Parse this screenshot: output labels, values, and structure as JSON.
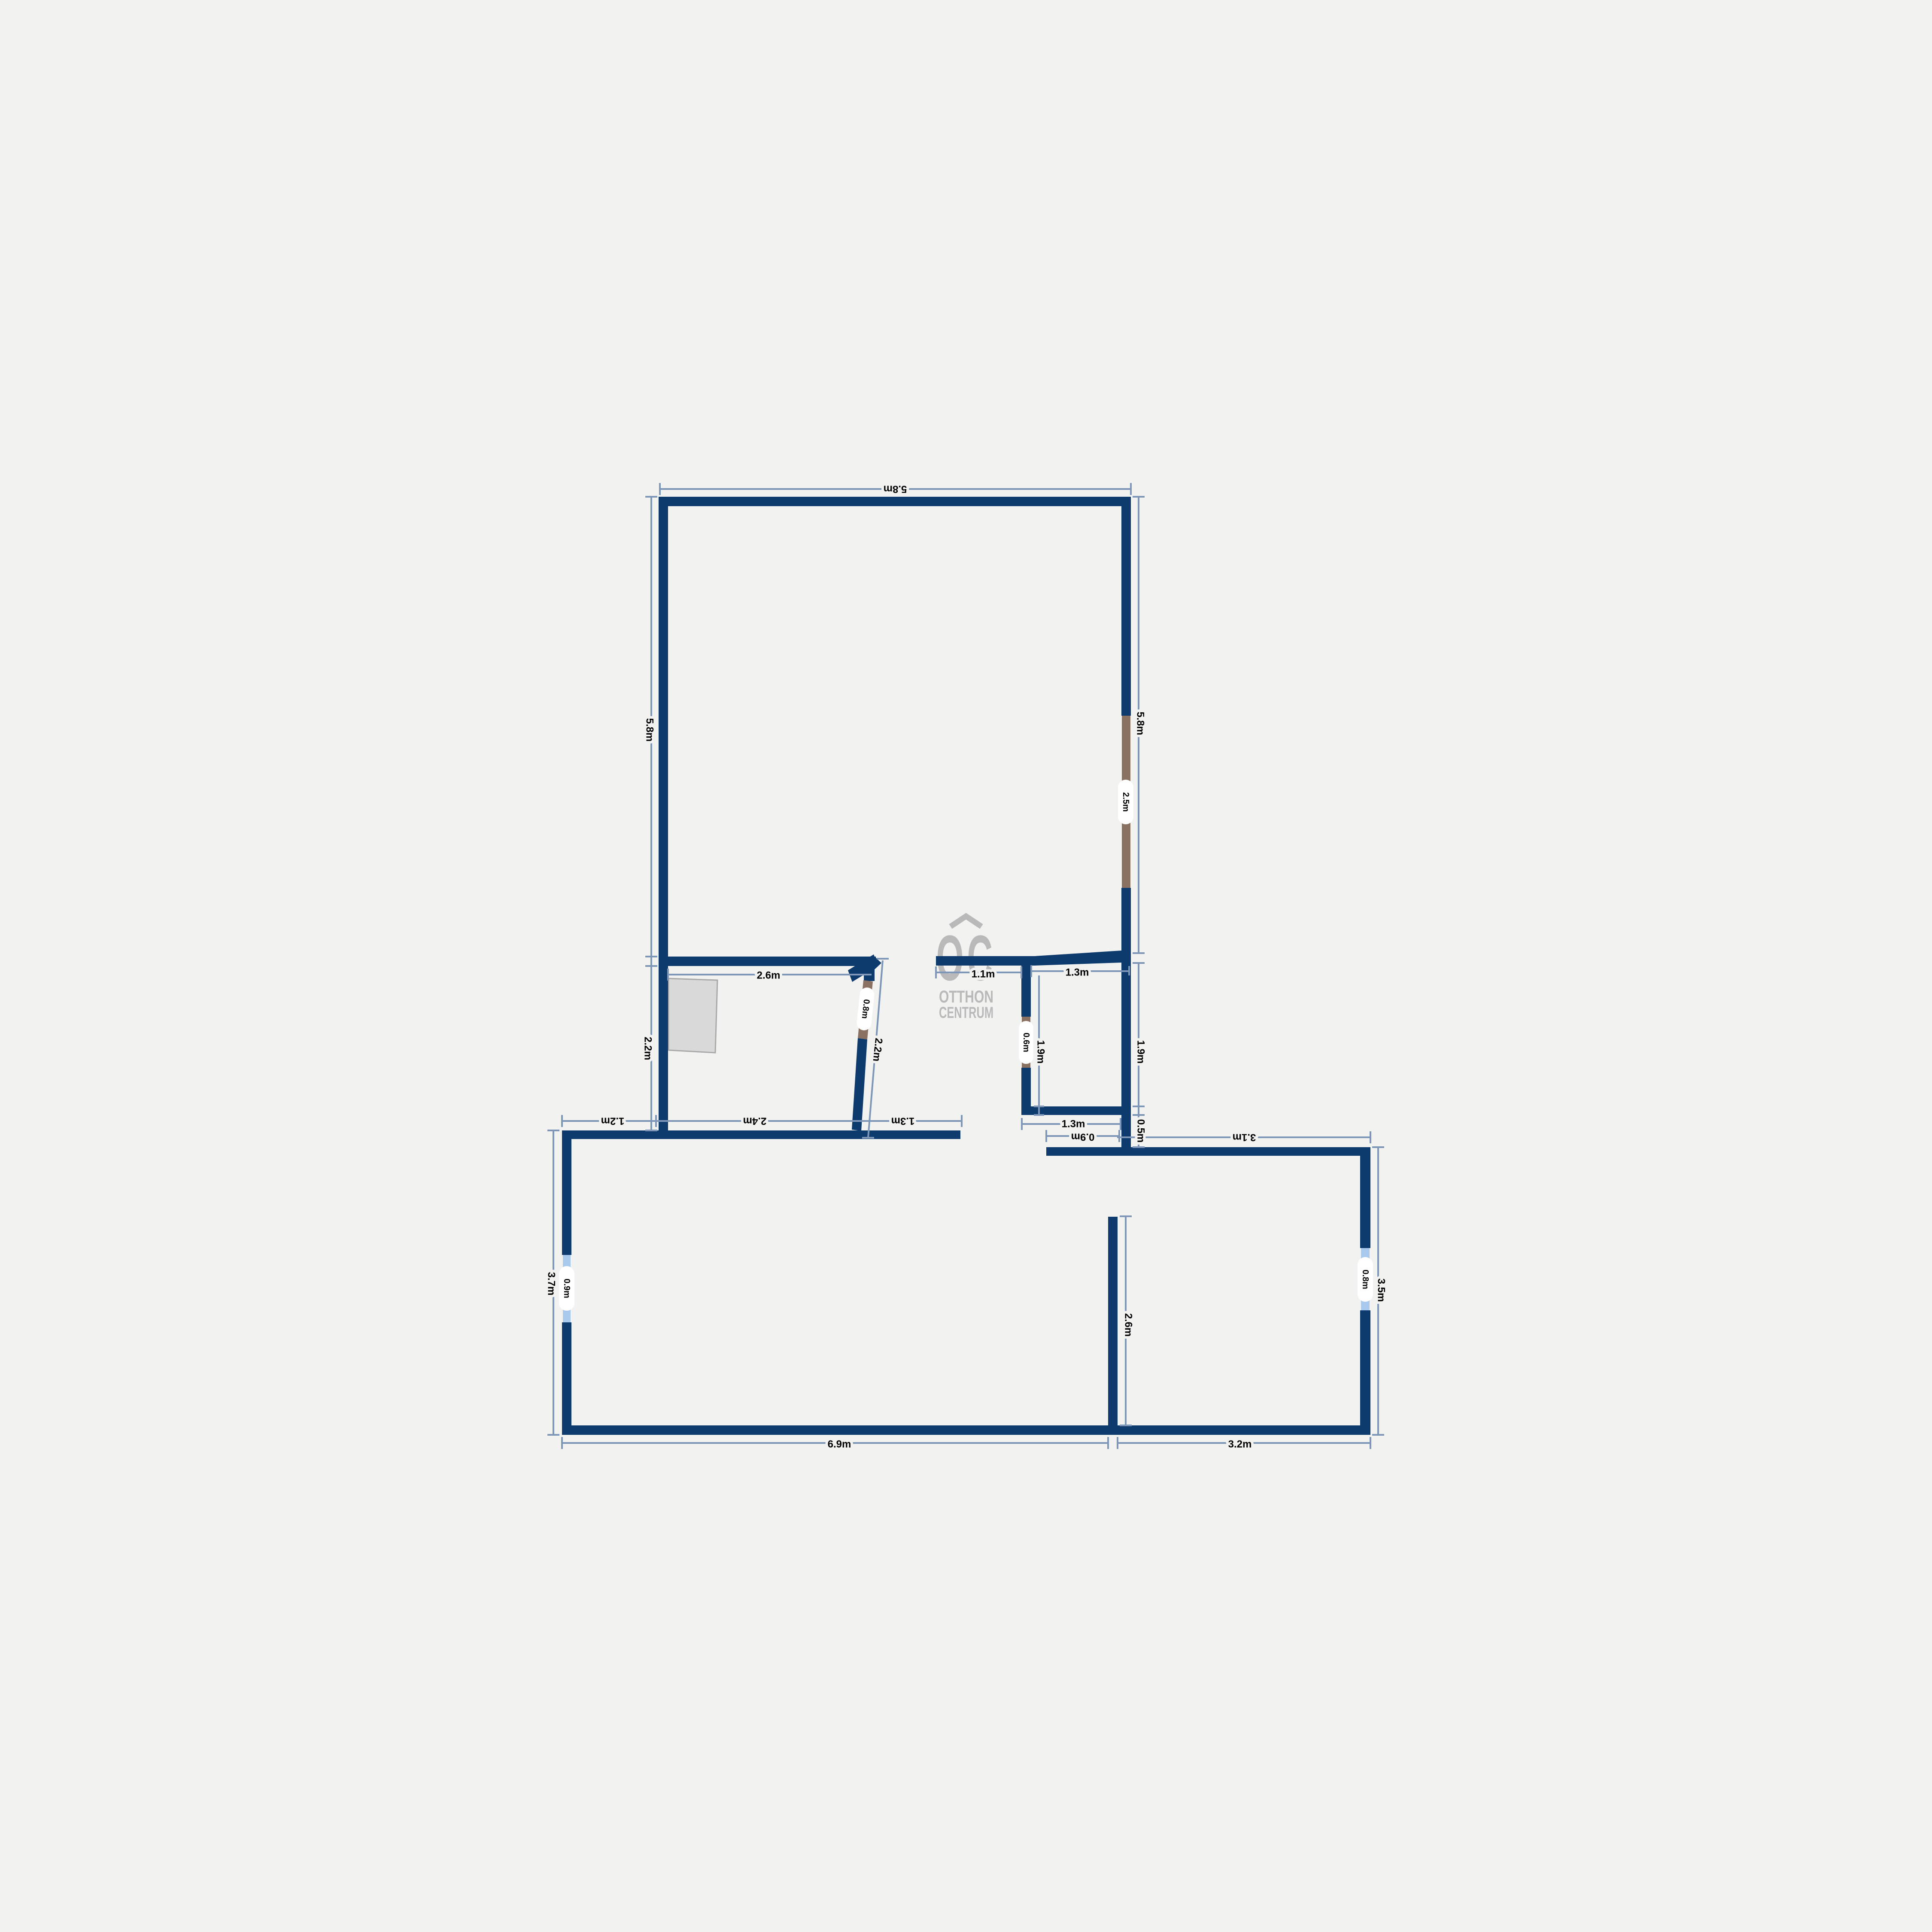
{
  "page": {
    "type": "floor-plan",
    "background": "#f2f2f1"
  },
  "colors": {
    "background": "#f2f2f1",
    "wall": "#0d3b6e",
    "door": "#8a7161",
    "window": "#a9c8ee",
    "dimension_line": "#7e97b8",
    "label_text": "#000000",
    "pill_background": "#ffffff",
    "closet_fill": "#d9d9d9",
    "closet_border": "#a9a9a9",
    "logo_gray": "#b9b9b9"
  },
  "logo": {
    "monogram": "OC",
    "name_line1": "OTTHON",
    "name_line2": "CENTRUM"
  },
  "dimensions": {
    "top_width": "5.8m",
    "upper_left_height": "5.8m",
    "upper_left_lower_height": "2.2m",
    "upper_right_height": "5.8m",
    "right_door_width": "2.5m",
    "closet_wall_width": "2.6m",
    "entry_left_width": "1.1m",
    "entry_right_width": "1.3m",
    "diagonal_door_width": "0.8m",
    "diagonal_wall_length": "2.2m",
    "bath_left_height": "1.9m",
    "bath_right_height": "1.9m",
    "bath_door_width": "0.6m",
    "bath_width": "1.3m",
    "passage_width": "0.9m",
    "wall_offset_height": "0.5m",
    "hall_segment_left": "1.2m",
    "hall_segment_middle": "2.4m",
    "hall_segment_right": "1.3m",
    "living_top_width": "3.1m",
    "lower_left_height": "3.7m",
    "left_window_width": "0.9m",
    "bottom_left_width": "6.9m",
    "bottom_right_width": "3.2m",
    "interior_wall_height": "2.6m",
    "lower_right_height": "3.5m",
    "right_window_width": "0.8m"
  }
}
